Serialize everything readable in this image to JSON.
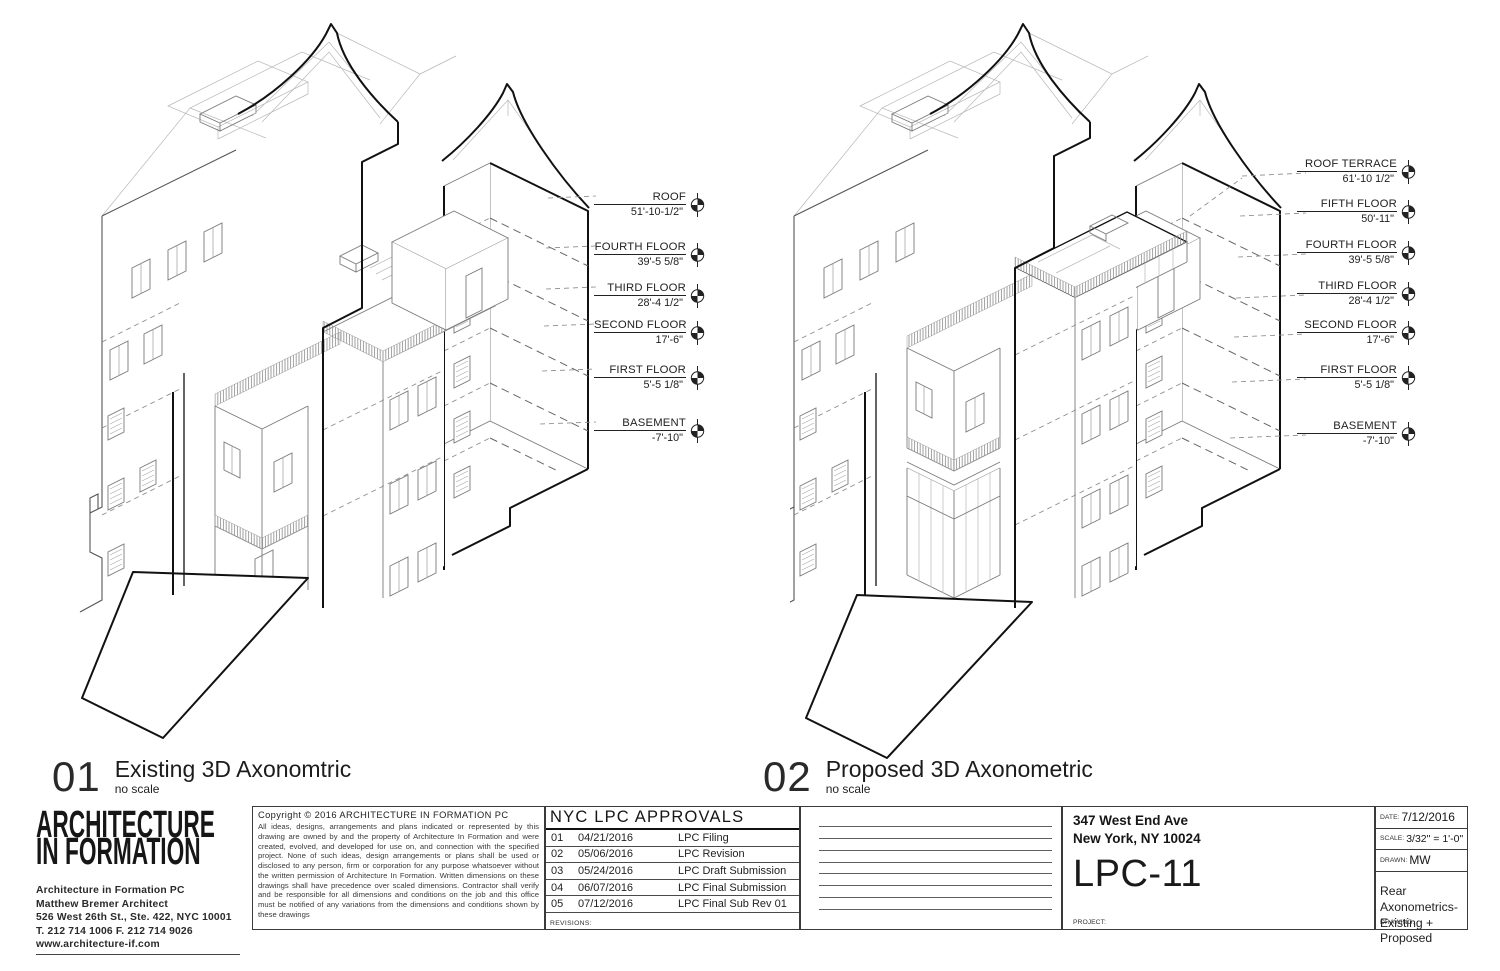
{
  "views": [
    {
      "number": "01",
      "title": "Existing 3D Axonomtric",
      "scale_note": "no scale",
      "levels": [
        {
          "name": "ROOF",
          "elevation": "51'-10-1/2\""
        },
        {
          "name": "FOURTH FLOOR",
          "elevation": "39'-5 5/8\""
        },
        {
          "name": "THIRD FLOOR",
          "elevation": "28'-4 1/2\""
        },
        {
          "name": "SECOND FLOOR",
          "elevation": "17'-6\""
        },
        {
          "name": "FIRST FLOOR",
          "elevation": "5'-5 1/8\""
        },
        {
          "name": "BASEMENT",
          "elevation": "-7'-10\""
        }
      ]
    },
    {
      "number": "02",
      "title": "Proposed 3D Axonometric",
      "scale_note": "no scale",
      "levels": [
        {
          "name": "ROOF TERRACE",
          "elevation": "61'-10 1/2\""
        },
        {
          "name": "FIFTH FLOOR",
          "elevation": "50'-11\""
        },
        {
          "name": "FOURTH FLOOR",
          "elevation": "39'-5 5/8\""
        },
        {
          "name": "THIRD FLOOR",
          "elevation": "28'-4 1/2\""
        },
        {
          "name": "SECOND FLOOR",
          "elevation": "17'-6\""
        },
        {
          "name": "FIRST FLOOR",
          "elevation": "5'-5 1/8\""
        },
        {
          "name": "BASEMENT",
          "elevation": "-7'-10\""
        }
      ]
    }
  ],
  "title_block": {
    "logo_line1": "ARCHITECTURE",
    "logo_line2": "IN FORMATION",
    "firm": [
      "Architecture in Formation PC",
      "Matthew Bremer Architect",
      "526 West 26th St., Ste. 422, NYC 10001",
      "T. 212 714 1006  F. 212 714 9026",
      "www.architecture-if.com"
    ],
    "copyright_title": "Copyright © 2016 ARCHITECTURE IN FORMATION PC",
    "copyright_body": "All ideas, designs, arrangements and plans indicated or represented by this drawing are owned by and the property of Architecture In Formation and were created, evolved, and developed for use on, and connection with the specified project. None of such ideas, design arrangements or plans shall be used or disclosed to any person, firm or corporation for any purpose whatsoever without the written permission of Architecture In Formation. Written dimensions on these drawings shall have precedence over scaled dimensions. Contractor shall verify and be responsible for all dimensions and conditions on the job and this office must be notified of any variations from the dimensions and conditions shown by these drawings",
    "approvals": {
      "title": "NYC LPC APPROVALS",
      "rows": [
        {
          "num": "01",
          "date": "04/21/2016",
          "desc": "LPC Filing"
        },
        {
          "num": "02",
          "date": "05/06/2016",
          "desc": "LPC Revision"
        },
        {
          "num": "03",
          "date": "05/24/2016",
          "desc": "LPC Draft Submission"
        },
        {
          "num": "04",
          "date": "06/07/2016",
          "desc": "LPC Final Submission"
        },
        {
          "num": "05",
          "date": "07/12/2016",
          "desc": "LPC Final Sub Rev 01"
        }
      ],
      "revisions_label": "REVISIONS:"
    },
    "project_address_line1": "347 West End Ave",
    "project_address_line2": "New York, NY 10024",
    "sheet_number": "LPC-11",
    "project_label": "PROJECT:",
    "date_label": "DATE:",
    "date": "7/12/2016",
    "scale_label": "SCALE:",
    "scale": "3/32\" = 1'-0\"",
    "drawn_label": "DRAWN:",
    "drawn": "MW",
    "drawing_title_line1": "Rear Axonometrics-",
    "drawing_title_line2": "Existing + Proposed",
    "drawing_label": "DRAWING:"
  }
}
